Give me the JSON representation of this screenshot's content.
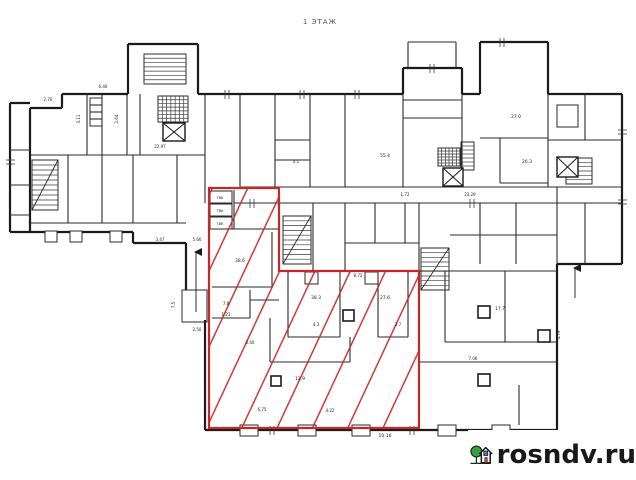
{
  "title": "1 ЭТАЖ",
  "watermark": {
    "text": "rosndv.ru"
  },
  "colors": {
    "wall": "#1a1a1a",
    "thin": "#2a2a2a",
    "hair": "#3a3a3a",
    "red": "#c62828",
    "label": "#222222",
    "logo_green": "#37a23c",
    "logo_dark": "#15301a",
    "logo_house": "#141414",
    "logo_door": "#d63a2f",
    "logo_window": "#4a74c9"
  },
  "plan": {
    "thick_walls": [
      [
        62,
        94,
        128,
        94
      ],
      [
        128,
        94,
        128,
        44
      ],
      [
        128,
        44,
        198,
        44
      ],
      [
        198,
        44,
        198,
        94
      ],
      [
        198,
        94,
        403,
        94
      ],
      [
        403,
        94,
        403,
        68
      ],
      [
        403,
        68,
        462,
        68
      ],
      [
        462,
        68,
        462,
        94
      ],
      [
        462,
        94,
        480,
        94
      ],
      [
        480,
        94,
        480,
        42
      ],
      [
        480,
        42,
        548,
        42
      ],
      [
        548,
        42,
        548,
        94
      ],
      [
        548,
        94,
        622,
        94
      ],
      [
        622,
        94,
        622,
        264
      ],
      [
        622,
        264,
        557,
        264
      ],
      [
        557,
        264,
        557,
        430
      ],
      [
        557,
        430,
        205,
        430
      ],
      [
        205,
        430,
        205,
        320
      ],
      [
        62,
        94,
        62,
        108
      ],
      [
        62,
        108,
        30,
        108
      ],
      [
        30,
        108,
        30,
        232
      ],
      [
        30,
        232,
        133,
        232
      ],
      [
        133,
        232,
        133,
        243
      ],
      [
        133,
        243,
        186,
        243
      ],
      [
        186,
        243,
        186,
        290
      ],
      [
        10,
        103,
        30,
        103
      ],
      [
        10,
        103,
        10,
        232
      ],
      [
        10,
        232,
        30,
        232
      ]
    ],
    "walls": [
      [
        10,
        150,
        30,
        150
      ],
      [
        10,
        185,
        30,
        185
      ],
      [
        10,
        215,
        30,
        215
      ],
      [
        30,
        155,
        205,
        155
      ],
      [
        30,
        223,
        186,
        223
      ],
      [
        87,
        94,
        87,
        155
      ],
      [
        102,
        94,
        102,
        155
      ],
      [
        127,
        94,
        127,
        155
      ],
      [
        140,
        94,
        140,
        155
      ],
      [
        68,
        155,
        68,
        223
      ],
      [
        102,
        155,
        102,
        223
      ],
      [
        133,
        155,
        133,
        223
      ],
      [
        177,
        155,
        177,
        223
      ],
      [
        205,
        94,
        205,
        203
      ],
      [
        240,
        94,
        240,
        187
      ],
      [
        275,
        94,
        275,
        187
      ],
      [
        310,
        94,
        310,
        187
      ],
      [
        345,
        94,
        345,
        187
      ],
      [
        275,
        140,
        310,
        140
      ],
      [
        275,
        160,
        310,
        160
      ],
      [
        403,
        94,
        403,
        187
      ],
      [
        462,
        94,
        462,
        187
      ],
      [
        403,
        100,
        462,
        100
      ],
      [
        403,
        118,
        462,
        118
      ],
      [
        408,
        42,
        408,
        68
      ],
      [
        456,
        42,
        456,
        68
      ],
      [
        408,
        42,
        456,
        42
      ],
      [
        480,
        138,
        548,
        138
      ],
      [
        500,
        138,
        500,
        183
      ],
      [
        500,
        183,
        548,
        183
      ],
      [
        548,
        94,
        548,
        187
      ],
      [
        548,
        140,
        622,
        140
      ],
      [
        585,
        94,
        585,
        140
      ],
      [
        557,
        187,
        557,
        264
      ],
      [
        585,
        203,
        585,
        264
      ],
      [
        240,
        187,
        622,
        187
      ],
      [
        234,
        203,
        622,
        203
      ],
      [
        313,
        203,
        313,
        271
      ],
      [
        345,
        203,
        345,
        271
      ],
      [
        375,
        203,
        375,
        243
      ],
      [
        405,
        203,
        405,
        243
      ],
      [
        345,
        243,
        419,
        243
      ],
      [
        419,
        203,
        419,
        271
      ],
      [
        480,
        203,
        480,
        264
      ],
      [
        516,
        203,
        516,
        264
      ],
      [
        450,
        235,
        557,
        235
      ],
      [
        419,
        271,
        557,
        271
      ],
      [
        445,
        271,
        445,
        342
      ],
      [
        445,
        342,
        557,
        342
      ],
      [
        419,
        362,
        557,
        362
      ],
      [
        505,
        271,
        505,
        342
      ],
      [
        519,
        385,
        519,
        425
      ],
      [
        90,
        105,
        102,
        105
      ],
      [
        90,
        112,
        102,
        112
      ],
      [
        90,
        119,
        102,
        119
      ],
      [
        234,
        190,
        234,
        229
      ],
      [
        209,
        229,
        279,
        229
      ],
      [
        212,
        287,
        272,
        287
      ],
      [
        272,
        232,
        272,
        287
      ],
      [
        250,
        290,
        250,
        318
      ],
      [
        212,
        318,
        250,
        318
      ],
      [
        250,
        300,
        279,
        300
      ],
      [
        270,
        318,
        270,
        362
      ],
      [
        270,
        362,
        350,
        362
      ],
      [
        350,
        337,
        350,
        362
      ],
      [
        288,
        271,
        288,
        337
      ],
      [
        340,
        271,
        340,
        337
      ],
      [
        288,
        337,
        340,
        337
      ],
      [
        378,
        271,
        378,
        337
      ],
      [
        408,
        271,
        408,
        337
      ],
      [
        378,
        337,
        408,
        337
      ]
    ],
    "ticks": [
      [
        225,
        90,
        225,
        99
      ],
      [
        229,
        90,
        229,
        99
      ],
      [
        300,
        90,
        300,
        99
      ],
      [
        304,
        90,
        304,
        99
      ],
      [
        355,
        90,
        355,
        99
      ],
      [
        359,
        90,
        359,
        99
      ],
      [
        430,
        64,
        430,
        73
      ],
      [
        434,
        64,
        434,
        73
      ],
      [
        500,
        38,
        500,
        47
      ],
      [
        504,
        38,
        504,
        47
      ],
      [
        618,
        130,
        627,
        130
      ],
      [
        618,
        134,
        627,
        134
      ],
      [
        618,
        200,
        627,
        200
      ],
      [
        618,
        204,
        627,
        204
      ],
      [
        270,
        426,
        270,
        435
      ],
      [
        274,
        426,
        274,
        435
      ],
      [
        410,
        426,
        410,
        435
      ],
      [
        414,
        426,
        414,
        435
      ],
      [
        6,
        160,
        15,
        160
      ],
      [
        6,
        164,
        15,
        164
      ],
      [
        250,
        199,
        250,
        208
      ],
      [
        254,
        199,
        254,
        208
      ],
      [
        470,
        199,
        470,
        208
      ],
      [
        474,
        199,
        474,
        208
      ]
    ],
    "rects": [
      [
        90,
        98,
        12,
        28,
        0
      ],
      [
        557,
        105,
        21,
        22,
        0
      ],
      [
        182,
        290,
        25,
        32,
        0
      ],
      [
        210,
        191,
        22,
        12,
        0
      ],
      [
        210,
        204,
        22,
        12,
        0
      ],
      [
        210,
        217,
        22,
        12,
        0
      ],
      [
        305,
        272,
        13,
        12,
        0
      ],
      [
        365,
        272,
        13,
        12,
        0
      ],
      [
        240,
        425,
        18,
        11,
        1
      ],
      [
        298,
        425,
        18,
        11,
        1
      ],
      [
        352,
        425,
        18,
        11,
        1
      ],
      [
        438,
        425,
        18,
        11,
        1
      ],
      [
        492,
        425,
        18,
        11,
        1
      ],
      [
        45,
        231,
        12,
        11,
        1
      ],
      [
        70,
        231,
        12,
        11,
        1
      ],
      [
        110,
        231,
        12,
        11,
        1
      ]
    ],
    "pillars": [
      [
        271,
        376,
        10,
        10
      ],
      [
        343,
        310,
        11,
        11
      ],
      [
        478,
        306,
        12,
        12
      ],
      [
        478,
        374,
        12,
        12
      ],
      [
        538,
        330,
        12,
        12
      ]
    ],
    "stairs": [
      {
        "x": 158,
        "y": 96,
        "w": 30,
        "h": 26,
        "n": 7,
        "dir": "v",
        "cross": true
      },
      {
        "x": 144,
        "y": 54,
        "w": 42,
        "h": 30,
        "n": 7,
        "dir": "h"
      },
      {
        "x": 283,
        "y": 216,
        "w": 28,
        "h": 48,
        "n": 10,
        "dir": "h",
        "diag": true
      },
      {
        "x": 421,
        "y": 248,
        "w": 28,
        "h": 42,
        "n": 9,
        "dir": "h",
        "diag": true
      },
      {
        "x": 438,
        "y": 148,
        "w": 22,
        "h": 18,
        "n": 6,
        "dir": "v",
        "cross": true
      },
      {
        "x": 566,
        "y": 158,
        "w": 26,
        "h": 26,
        "n": 6,
        "dir": "h"
      },
      {
        "x": 461,
        "y": 142,
        "w": 13,
        "h": 28,
        "n": 7,
        "dir": "h"
      },
      {
        "x": 32,
        "y": 160,
        "w": 26,
        "h": 50,
        "n": 10,
        "dir": "h",
        "diag": true
      }
    ],
    "xboxes": [
      [
        163,
        123,
        22,
        18
      ],
      [
        443,
        168,
        20,
        18
      ],
      [
        557,
        157,
        21,
        20
      ]
    ],
    "red_polygon": "209,188 279,188 279,271 419,271 419,428 209,428",
    "arrows": [
      [
        196,
        312,
        196,
        252
      ],
      [
        575,
        298,
        575,
        268
      ]
    ],
    "labels": [
      {
        "x": 160,
        "y": 148,
        "t": "22.97",
        "s": 4
      },
      {
        "x": 103,
        "y": 88,
        "t": "6.40",
        "s": 4
      },
      {
        "x": 48,
        "y": 101,
        "t": "2.70",
        "s": 4
      },
      {
        "x": 358,
        "y": 277,
        "t": "8.72",
        "s": 4
      },
      {
        "x": 262,
        "y": 411,
        "t": "6.75",
        "s": 4
      },
      {
        "x": 385,
        "y": 437,
        "t": "10.16",
        "s": 4.5
      },
      {
        "x": 470,
        "y": 196,
        "t": "23.29",
        "s": 4
      },
      {
        "x": 240,
        "y": 262,
        "t": "38.6",
        "s": 4.5
      },
      {
        "x": 226,
        "y": 305,
        "t": "7.8",
        "s": 4
      },
      {
        "x": 226,
        "y": 316,
        "t": "1.23",
        "s": 4
      },
      {
        "x": 316,
        "y": 299,
        "t": "38.3",
        "s": 4.5
      },
      {
        "x": 385,
        "y": 299,
        "t": "27.6",
        "s": 4.5
      },
      {
        "x": 316,
        "y": 326,
        "t": "4.3",
        "s": 4
      },
      {
        "x": 398,
        "y": 326,
        "t": "2.7",
        "s": 4
      },
      {
        "x": 250,
        "y": 344,
        "t": "5.40",
        "s": 4
      },
      {
        "x": 160,
        "y": 241,
        "t": "3.47",
        "s": 4
      },
      {
        "x": 197,
        "y": 241,
        "t": "5.66",
        "s": 4
      },
      {
        "x": 197,
        "y": 331,
        "t": "2.50",
        "s": 4
      },
      {
        "x": 175,
        "y": 305,
        "t": "7.5",
        "s": 4,
        "r": -90
      },
      {
        "x": 516,
        "y": 118,
        "t": "27.0",
        "s": 4.5
      },
      {
        "x": 385,
        "y": 157,
        "t": "55.4",
        "s": 4.5
      },
      {
        "x": 80,
        "y": 119,
        "t": "3.11",
        "s": 4,
        "r": -90
      },
      {
        "x": 118,
        "y": 119,
        "t": "2.64",
        "s": 4,
        "r": -90
      },
      {
        "x": 296,
        "y": 163,
        "t": "4.1",
        "s": 4
      },
      {
        "x": 405,
        "y": 196,
        "t": "1.72",
        "s": 4
      },
      {
        "x": 473,
        "y": 360,
        "t": "7.06",
        "s": 4
      },
      {
        "x": 330,
        "y": 412,
        "t": "4.22",
        "s": 4
      },
      {
        "x": 560,
        "y": 335,
        "t": "4.79",
        "s": 4,
        "r": -90
      },
      {
        "x": 527,
        "y": 163,
        "t": "26.3",
        "s": 4.5
      },
      {
        "x": 500,
        "y": 310,
        "t": "17.7",
        "s": 4.5
      },
      {
        "x": 300,
        "y": 380,
        "t": "12.9",
        "s": 4.5
      },
      {
        "x": 220,
        "y": 199,
        "t": "ТВК",
        "s": 3.5
      },
      {
        "x": 220,
        "y": 212,
        "t": "ТВК",
        "s": 3.5
      },
      {
        "x": 220,
        "y": 225,
        "t": "ТВК",
        "s": 3.5
      }
    ]
  }
}
